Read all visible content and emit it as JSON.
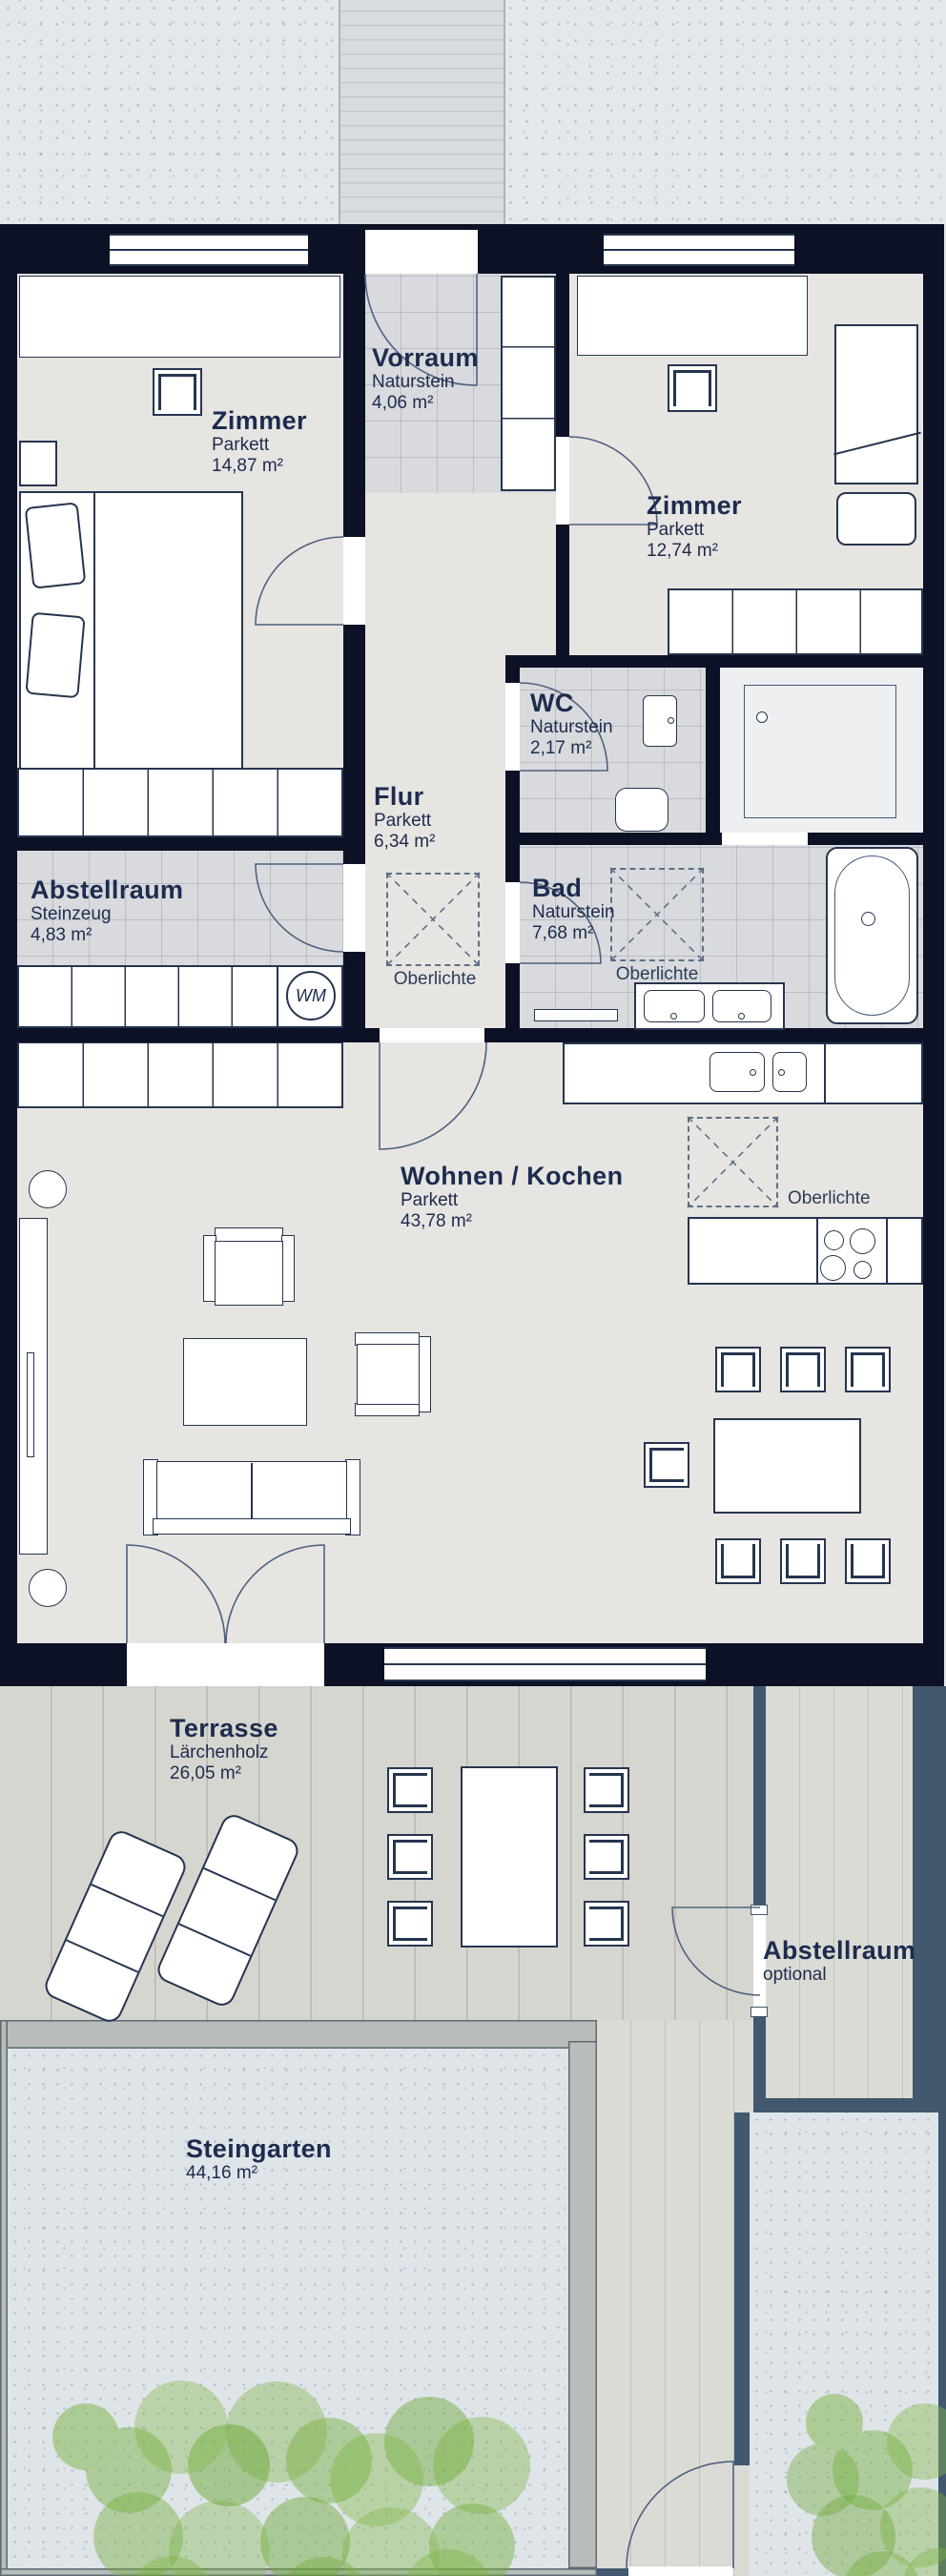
{
  "colors": {
    "wall": "#0c1126",
    "text": "#1d2b4e",
    "slate_wall": "#41586e",
    "plant_green": "#7cb442"
  },
  "rooms": {
    "zimmer1": {
      "name": "Zimmer",
      "floor": "Parkett",
      "area": "14,87 m²"
    },
    "vorraum": {
      "name": "Vorraum",
      "floor": "Naturstein",
      "area": "4,06 m²"
    },
    "zimmer2": {
      "name": "Zimmer",
      "floor": "Parkett",
      "area": "12,74 m²"
    },
    "wc": {
      "name": "WC",
      "floor": "Naturstein",
      "area": "2,17 m²"
    },
    "flur": {
      "name": "Flur",
      "floor": "Parkett",
      "area": "6,34 m²"
    },
    "abstellraum": {
      "name": "Abstellraum",
      "floor": "Steinzeug",
      "area": "4,83 m²"
    },
    "bad": {
      "name": "Bad",
      "floor": "Naturstein",
      "area": "7,68 m²"
    },
    "wohnen_kochen": {
      "name": "Wohnen / Kochen",
      "floor": "Parkett",
      "area": "43,78 m²"
    },
    "terrasse": {
      "name": "Terrasse",
      "floor": "Lärchenholz",
      "area": "26,05 m²"
    },
    "abstellraum_optional": {
      "name": "Abstellraum",
      "floor": "optional"
    },
    "steingarten": {
      "name": "Steingarten",
      "area": "44,16 m²"
    }
  },
  "labels": {
    "oberlichte": "Oberlichte",
    "washing_machine": "WM"
  }
}
